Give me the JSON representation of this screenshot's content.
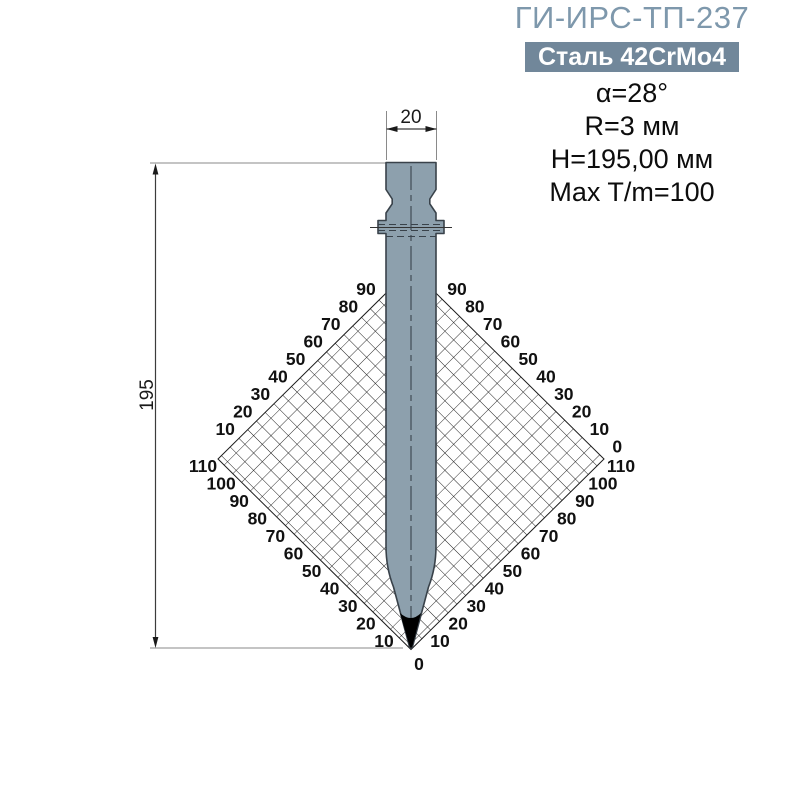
{
  "header": {
    "title": "ГИ-ИРС-ТП-237",
    "material_badge": "Сталь 42CrMo4",
    "specs": [
      "α=28°",
      "R=3 мм",
      "H=195,00 мм",
      "Max T/m=100"
    ]
  },
  "drawing": {
    "width_label": "20",
    "height_label": "195",
    "chart": {
      "upper_left": [
        "90",
        "80",
        "70",
        "60",
        "50",
        "40",
        "30",
        "20",
        "10"
      ],
      "upper_right": [
        "90",
        "80",
        "70",
        "60",
        "50",
        "40",
        "30",
        "20",
        "10",
        "0"
      ],
      "lower_left": [
        "110",
        "100",
        "90",
        "80",
        "70",
        "60",
        "50",
        "40",
        "30",
        "20",
        "10"
      ],
      "lower_right": [
        "110",
        "100",
        "90",
        "80",
        "70",
        "60",
        "50",
        "40",
        "30",
        "20",
        "10"
      ],
      "bottom": "0"
    }
  },
  "colors": {
    "title_accent": "#7e98ac",
    "badge_bg": "#71879a",
    "badge_text": "#ffffff",
    "tool_fill": "#8da0ad",
    "tool_stroke": "#39424a",
    "tip_fill": "#000000",
    "grid_line": "#1c1c1c",
    "dim_line": "#3c3c3c",
    "ext_line": "#8a8a8a"
  }
}
